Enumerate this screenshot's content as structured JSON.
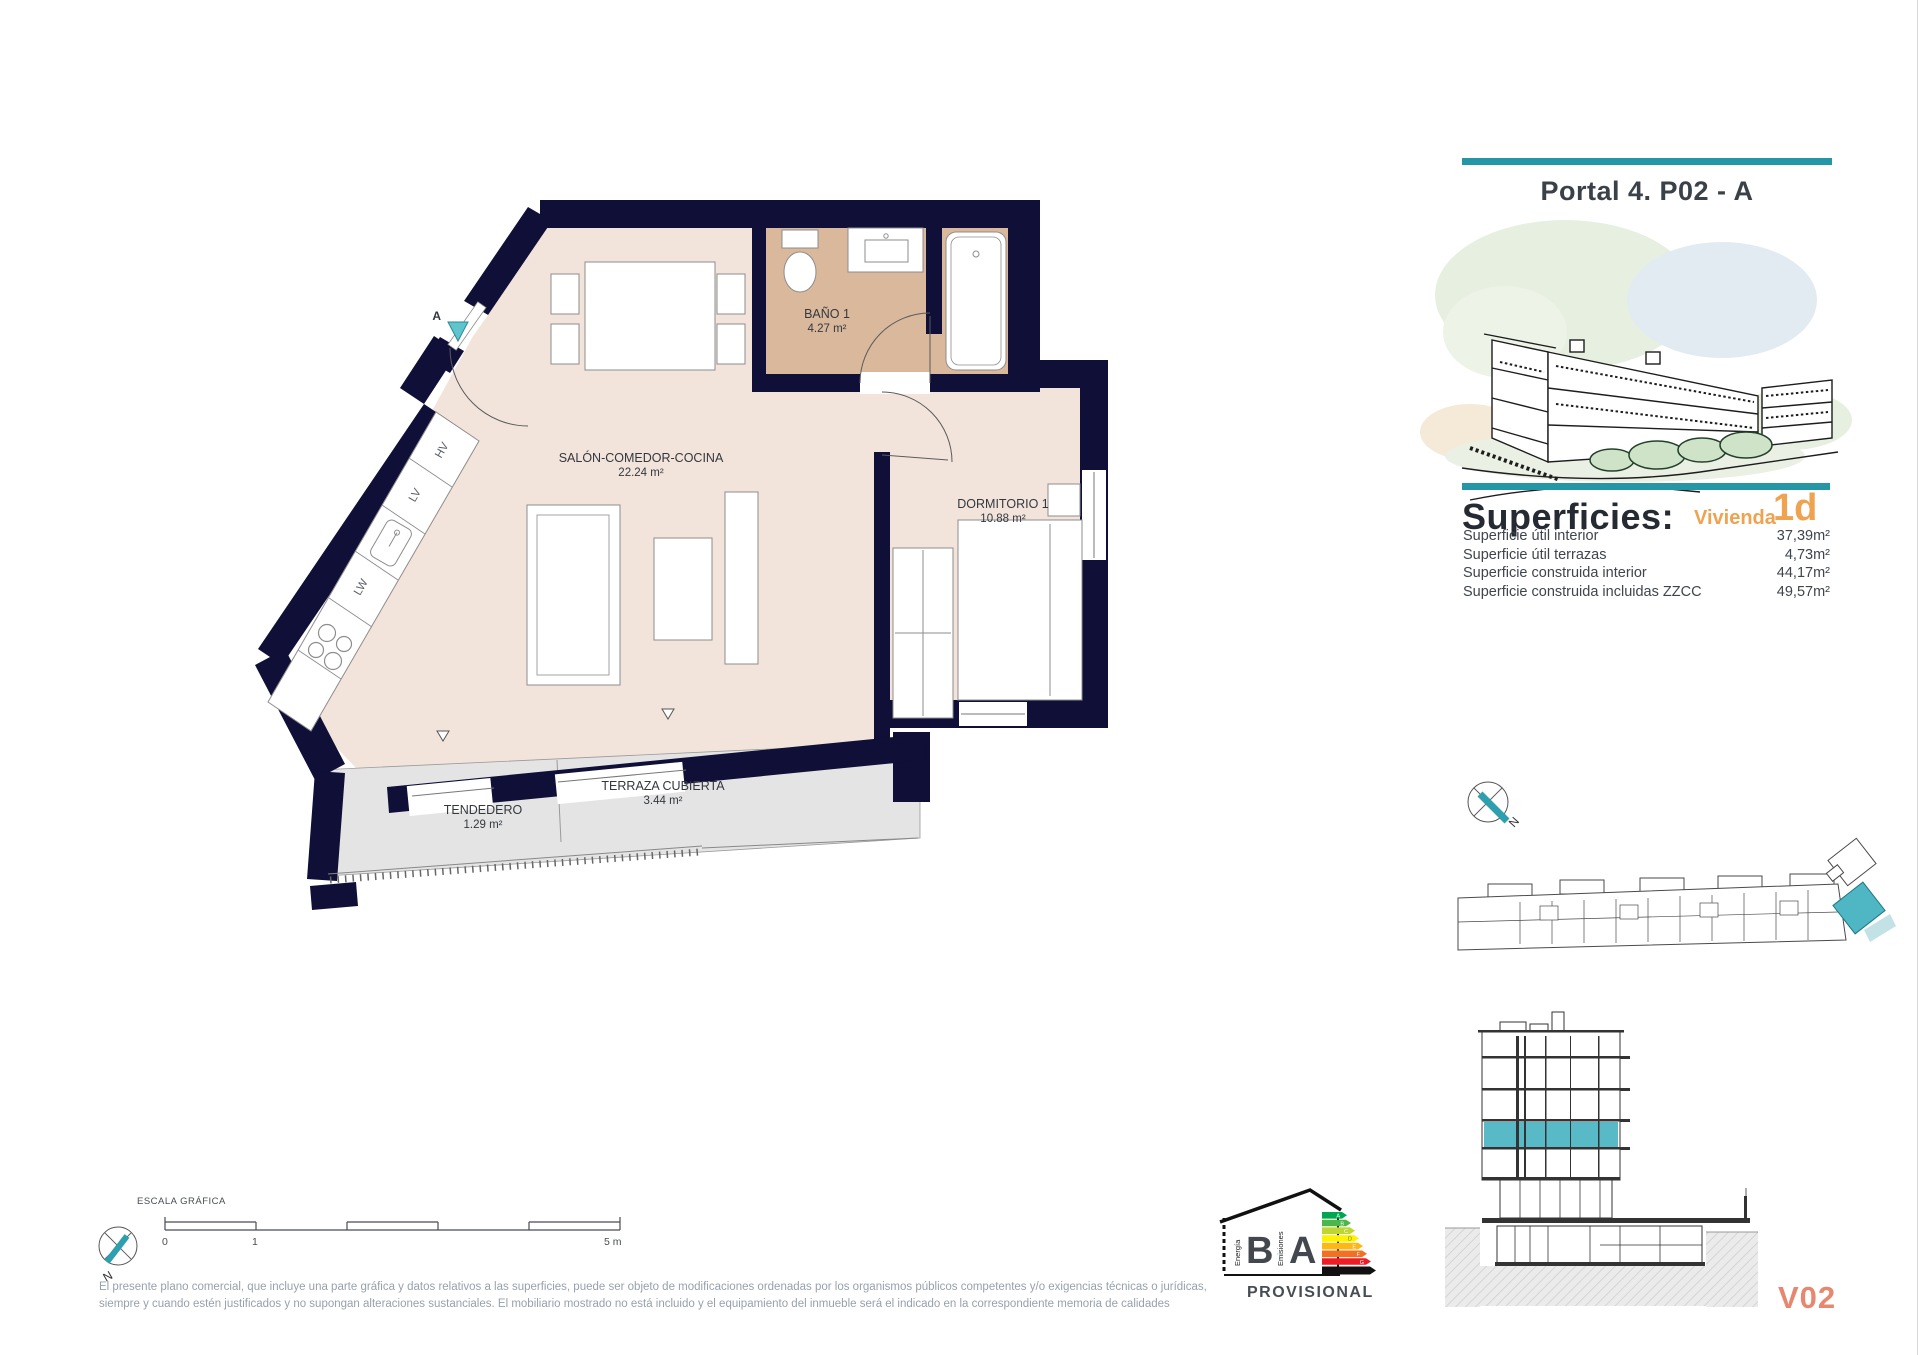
{
  "page": {
    "title_right": "Portal 4. P02 - A"
  },
  "superficies": {
    "heading": "Superficies:",
    "vivienda_label": "Vivienda",
    "vivienda_code": "1d",
    "rows": [
      {
        "label": "Superficie útil interior",
        "value": "37,39m²"
      },
      {
        "label": "Superficie útil terrazas",
        "value": "4,73m²"
      },
      {
        "label": "Superficie construida interior",
        "value": "44,17m²"
      },
      {
        "label": "Superficie construida incluidas ZZCC",
        "value": "49,57m²"
      }
    ]
  },
  "plan": {
    "rooms": [
      {
        "name": "SALÓN-COMEDOR-COCINA",
        "area": "22.24 m²"
      },
      {
        "name": "BAÑO 1",
        "area": "4.27 m²"
      },
      {
        "name": "DORMITORIO 1",
        "area": "10.88 m²"
      },
      {
        "name": "TERRAZA CUBIERTA",
        "area": "3.44 m²"
      },
      {
        "name": "TENDEDERO",
        "area": "1.29 m²"
      }
    ],
    "kitchen_labels": {
      "oven": "HV",
      "dishwasher": "LV",
      "washer": "LW"
    },
    "entrance_label": "A",
    "north_label": "N"
  },
  "scale_bar": {
    "title": "ESCALA GRÁFICA",
    "tick_zero": "0",
    "tick_one": "1",
    "tick_five": "5 m"
  },
  "energy_label": {
    "letter_energy": "B",
    "letter_emissions": "A",
    "energia": "Energía",
    "emisiones": "Emisiones",
    "status": "PROVISIONAL",
    "arrow_letters": [
      "A",
      "B",
      "C",
      "D",
      "E",
      "F",
      "G"
    ]
  },
  "key_plan": {
    "north_label": "N"
  },
  "section": {
    "code": "V02"
  },
  "disclaimer": {
    "line1": "El presente plano comercial, que incluye una parte gráfica y datos relativos a las superficies, puede ser objeto de modificaciones ordenadas por los organismos públicos competentes y/o exigencias técnicas o jurídicas,",
    "line2": "siempre y cuando estén justificados y no supongan alteraciones sustanciales. El mobiliario mostrado no está incluido y el equipamiento del inmueble será el indicado en la correspondiente memoria de calidades"
  },
  "colors": {
    "wall_navy": "#0F0F38",
    "room_beige": "#F2E4DA",
    "bath_tan": "#D9B89C",
    "terrace_gray": "#E4E4E4",
    "accent_teal": "#2596A5",
    "highlight_teal": "#4FB6C3",
    "orange": "#EFA24F",
    "salmon": "#E8876F"
  }
}
